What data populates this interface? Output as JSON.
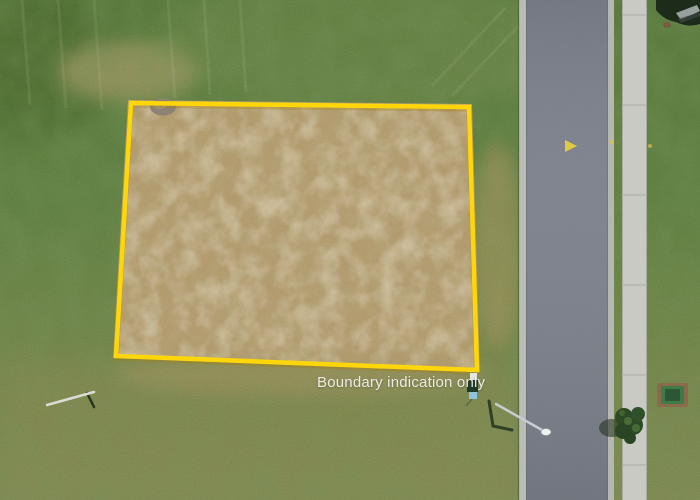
{
  "scene": {
    "description": "Aerial drone photo of a vacant grass section outlined in yellow beside a suburban road and footpath",
    "note": "Boundary indication only",
    "objects": [
      "vacant-lot",
      "boundary-outline",
      "road",
      "left-kerb",
      "right-kerb",
      "footpath",
      "road-arrow-marking",
      "street-lamp",
      "lamp-shadow",
      "survey-peg",
      "marker-stick",
      "rock",
      "tree",
      "utility-box",
      "hedge",
      "wall-corner"
    ]
  },
  "palette": {
    "grass_green": "#587b3d",
    "grass_dark": "#44612c",
    "grass_light": "#7c8a4e",
    "dry_patch": "#94905d",
    "lot_tan": "#ae9669",
    "bottom_olive": "#85834f",
    "road_gray": "#7a7f89",
    "kerb_light": "#b9bcb4",
    "footpath_concrete": "#c9cac3",
    "boundary_yellow": "#ffd60a",
    "arrow_yellow": "#e2c945",
    "note_white": "#f1f1ec",
    "tree_dark": "#2d4a27",
    "utility_green": "#3f7a49",
    "utility_brown": "#8a6a48",
    "lamp_gray": "#c7cdd2",
    "peg_blue": "#8fc3dc",
    "shadow_dark": "#22331f"
  }
}
